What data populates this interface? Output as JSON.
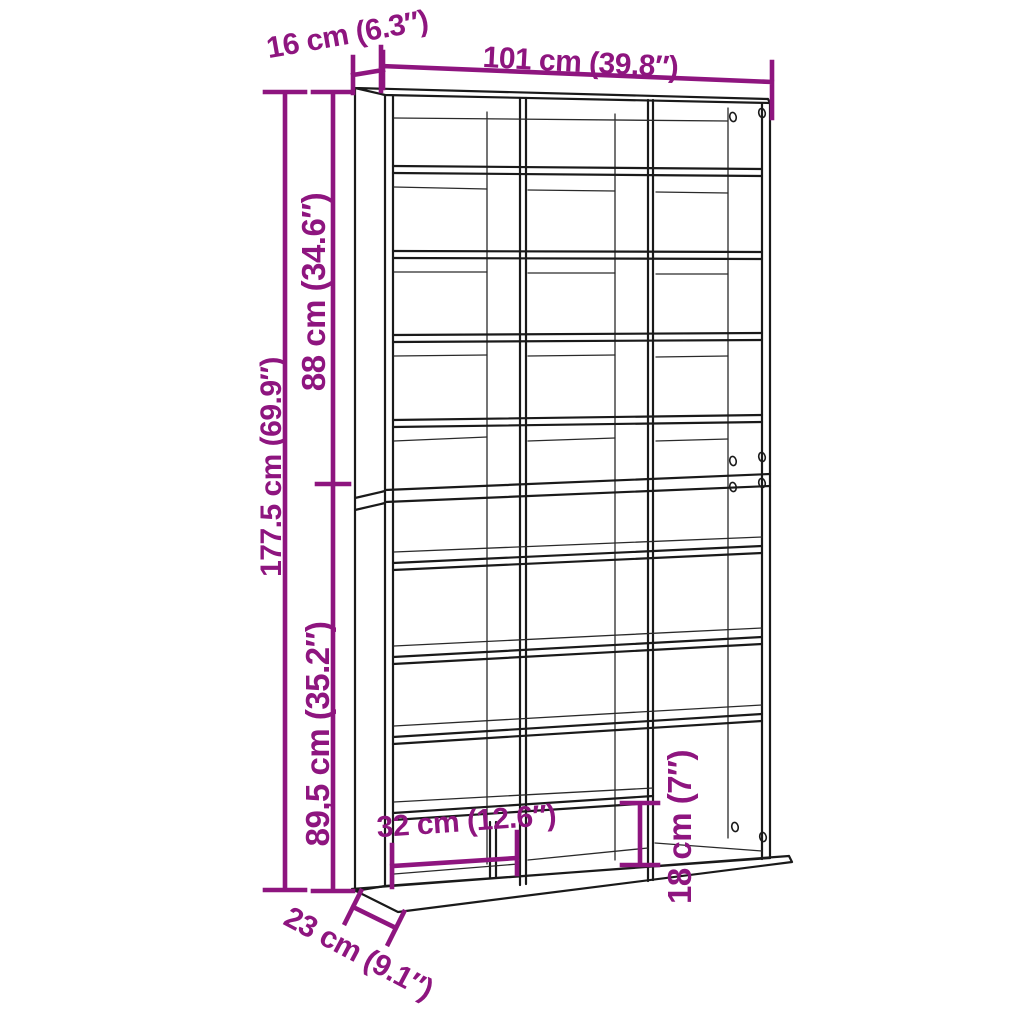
{
  "diagram": {
    "type": "product-dimension-line-drawing",
    "subject": "tall open shelving unit with 3 columns of compartments, stacked upper and lower sections, on a deeper base board",
    "colors": {
      "dimension_annotation": "#8E157F",
      "outline": "#1A1A1A",
      "background": "#FFFFFF"
    },
    "dimensions": [
      {
        "id": "top-depth",
        "label": "16 cm (6.3″)",
        "orientation": "diagonal-top"
      },
      {
        "id": "width",
        "label": "101 cm (39.8″)",
        "orientation": "horizontal-top"
      },
      {
        "id": "upper-section-height",
        "label": "88 cm (34.6″)",
        "orientation": "vertical-left"
      },
      {
        "id": "total-height",
        "label": "177.5 cm (69.9″)",
        "orientation": "vertical-left"
      },
      {
        "id": "lower-section-height",
        "label": "89,5 cm (35.2″)",
        "orientation": "vertical-left"
      },
      {
        "id": "compartment-width",
        "label": "32 cm (12.6″)",
        "orientation": "horizontal-bottom"
      },
      {
        "id": "bottom-compartment-height",
        "label": "18 cm (7″)",
        "orientation": "vertical-bottom"
      },
      {
        "id": "base-depth",
        "label": "23 cm (9.1″)",
        "orientation": "diagonal-bottom"
      }
    ]
  }
}
